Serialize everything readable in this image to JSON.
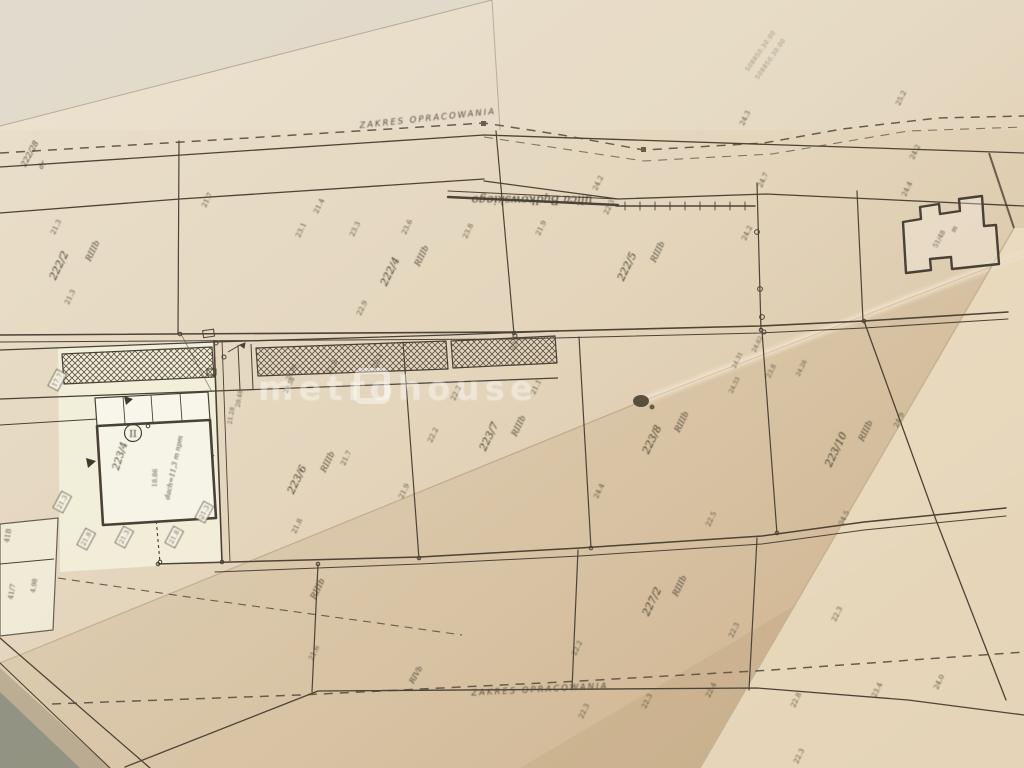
{
  "meta": {
    "title": "cadastral map photo",
    "watermark": "metrohouse"
  },
  "labels": [
    {
      "t": "ZAKRES OPRACOWANIA",
      "x": 428,
      "y": 121,
      "r": -6,
      "s": 8.5,
      "k": "zakres"
    },
    {
      "t": "ZAKRES OPRACOWANIA",
      "x": 540,
      "y": 692,
      "r": -3,
      "s": 8.5,
      "k": "zakres"
    },
    {
      "t": "ulica Bądkowskiego",
      "x": 532,
      "y": 196,
      "r": 180,
      "s": 12,
      "k": "street"
    },
    {
      "t": "508850.30.00",
      "x": 762,
      "y": 52,
      "r": -55,
      "s": 6,
      "k": "stamp"
    },
    {
      "t": "508850.30.00",
      "x": 772,
      "y": 60,
      "r": -55,
      "s": 6,
      "k": "stamp"
    },
    {
      "t": "metrohouse",
      "x": 398,
      "y": 400,
      "r": 0,
      "s": 34,
      "k": "wm",
      "a": "start"
    },
    {
      "t": "222/28",
      "x": 32,
      "y": 155,
      "r": -62,
      "s": 8,
      "k": "parcel"
    },
    {
      "t": "dr",
      "x": 44,
      "y": 166,
      "r": -62,
      "s": 7,
      "k": "soil"
    },
    {
      "t": "222/2",
      "x": 62,
      "y": 267,
      "r": -64,
      "s": 10.5,
      "k": "parcel"
    },
    {
      "t": "RIIIb",
      "x": 95,
      "y": 252,
      "r": -64,
      "s": 8.5,
      "k": "soil"
    },
    {
      "t": "222/4",
      "x": 393,
      "y": 273,
      "r": -64,
      "s": 10.5,
      "k": "parcel"
    },
    {
      "t": "RIIIb",
      "x": 424,
      "y": 257,
      "r": -64,
      "s": 8.5,
      "k": "soil"
    },
    {
      "t": "222/5",
      "x": 630,
      "y": 268,
      "r": -64,
      "s": 10.5,
      "k": "parcel"
    },
    {
      "t": "RIIIb",
      "x": 660,
      "y": 253,
      "r": -64,
      "s": 8.5,
      "k": "soil"
    },
    {
      "t": "223/6",
      "x": 300,
      "y": 481,
      "r": -64,
      "s": 10.5,
      "k": "parcel"
    },
    {
      "t": "RIIIb",
      "x": 330,
      "y": 463,
      "r": -64,
      "s": 8.5,
      "k": "soil"
    },
    {
      "t": "21.7",
      "x": 348,
      "y": 459,
      "r": -64,
      "s": 7,
      "k": "elev"
    },
    {
      "t": "223/7",
      "x": 492,
      "y": 438,
      "r": -64,
      "s": 10.5,
      "k": "parcel"
    },
    {
      "t": "RIIIb",
      "x": 521,
      "y": 427,
      "r": -64,
      "s": 8.5,
      "k": "soil"
    },
    {
      "t": "223/8",
      "x": 655,
      "y": 441,
      "r": -64,
      "s": 10.5,
      "k": "parcel"
    },
    {
      "t": "RIIIb",
      "x": 684,
      "y": 423,
      "r": -64,
      "s": 8.5,
      "k": "soil"
    },
    {
      "t": "223/10",
      "x": 839,
      "y": 451,
      "r": -64,
      "s": 10.5,
      "k": "parcel"
    },
    {
      "t": "RIIIb",
      "x": 868,
      "y": 432,
      "r": -64,
      "s": 8.5,
      "k": "soil"
    },
    {
      "t": "227/2",
      "x": 655,
      "y": 603,
      "r": -64,
      "s": 10.5,
      "k": "parcel"
    },
    {
      "t": "RIIIb",
      "x": 682,
      "y": 587,
      "r": -64,
      "s": 8.5,
      "k": "soil"
    },
    {
      "t": "223/4",
      "x": 123,
      "y": 457,
      "r": -72,
      "s": 10,
      "k": "parcel"
    },
    {
      "t": "RIIIb",
      "x": 320,
      "y": 590,
      "r": -64,
      "s": 8.5,
      "k": "soil"
    },
    {
      "t": "RIVb",
      "x": 418,
      "y": 676,
      "r": -60,
      "s": 7.5,
      "k": "soil"
    },
    {
      "t": "dach=11,3 m npm",
      "x": 176,
      "y": 468,
      "r": -78,
      "s": 7,
      "k": "note"
    },
    {
      "t": "18.86",
      "x": 157,
      "y": 478,
      "r": -88,
      "s": 6.5,
      "k": "tiny"
    },
    {
      "t": "51/48",
      "x": 941,
      "y": 240,
      "r": -62,
      "s": 6.5,
      "k": "tiny"
    },
    {
      "t": "m",
      "x": 956,
      "y": 230,
      "r": -62,
      "s": 6.5,
      "k": "tiny"
    },
    {
      "t": "II",
      "x": 133,
      "y": 437,
      "r": 0,
      "s": 9.5,
      "k": "circled"
    },
    {
      "t": "41B",
      "x": 10,
      "y": 536,
      "r": -80,
      "s": 7,
      "k": "tiny"
    },
    {
      "t": "41/7",
      "x": 14,
      "y": 592,
      "r": -80,
      "s": 7,
      "k": "tiny"
    },
    {
      "t": "4.98",
      "x": 36,
      "y": 586,
      "r": -80,
      "s": 6.5,
      "k": "tiny"
    },
    {
      "t": "21.3",
      "x": 58,
      "y": 228,
      "r": -64,
      "s": 7,
      "k": "elev"
    },
    {
      "t": "21.3",
      "x": 72,
      "y": 298,
      "r": -64,
      "s": 7,
      "k": "elev"
    },
    {
      "t": "21.7",
      "x": 209,
      "y": 201,
      "r": -64,
      "s": 7,
      "k": "elev"
    },
    {
      "t": "21.4",
      "x": 321,
      "y": 207,
      "r": -64,
      "s": 7,
      "k": "elev"
    },
    {
      "t": "23.1",
      "x": 303,
      "y": 231,
      "r": -64,
      "s": 7,
      "k": "elev"
    },
    {
      "t": "23.3",
      "x": 357,
      "y": 230,
      "r": -64,
      "s": 7,
      "k": "elev"
    },
    {
      "t": "23.6",
      "x": 409,
      "y": 228,
      "r": -64,
      "s": 7,
      "k": "elev"
    },
    {
      "t": "23.8",
      "x": 470,
      "y": 232,
      "r": -64,
      "s": 7,
      "k": "elev"
    },
    {
      "t": "21.9",
      "x": 543,
      "y": 229,
      "r": -64,
      "s": 7,
      "k": "elev"
    },
    {
      "t": "22.3",
      "x": 611,
      "y": 208,
      "r": -64,
      "s": 7,
      "k": "elev"
    },
    {
      "t": "24.2",
      "x": 600,
      "y": 184,
      "r": -64,
      "s": 7,
      "k": "elev"
    },
    {
      "t": "22.9",
      "x": 364,
      "y": 309,
      "r": -64,
      "s": 7,
      "k": "elev"
    },
    {
      "t": "24.3",
      "x": 747,
      "y": 119,
      "r": -64,
      "s": 7,
      "k": "elev"
    },
    {
      "t": "24.7",
      "x": 765,
      "y": 181,
      "r": -64,
      "s": 7,
      "k": "elev"
    },
    {
      "t": "24.2",
      "x": 749,
      "y": 234,
      "r": -64,
      "s": 7,
      "k": "elev"
    },
    {
      "t": "25.2",
      "x": 903,
      "y": 99,
      "r": -64,
      "s": 7,
      "k": "elev"
    },
    {
      "t": "24.2",
      "x": 917,
      "y": 153,
      "r": -64,
      "s": 7,
      "k": "elev"
    },
    {
      "t": "24.4",
      "x": 909,
      "y": 190,
      "r": -64,
      "s": 7,
      "k": "elev"
    },
    {
      "t": "23.1",
      "x": 517,
      "y": 344,
      "r": -64,
      "s": 7,
      "k": "elev"
    },
    {
      "t": "22.3",
      "x": 379,
      "y": 362,
      "r": -64,
      "s": 7,
      "k": "elev"
    },
    {
      "t": "22.2",
      "x": 334,
      "y": 368,
      "r": -64,
      "s": 7,
      "k": "elev"
    },
    {
      "t": "20.98",
      "x": 293,
      "y": 373,
      "r": -64,
      "s": 6,
      "k": "elev"
    },
    {
      "t": "20.58",
      "x": 291,
      "y": 386,
      "r": -64,
      "s": 6,
      "k": "elev"
    },
    {
      "t": "21.28",
      "x": 233,
      "y": 416,
      "r": -80,
      "s": 6,
      "k": "elev"
    },
    {
      "t": "20.48",
      "x": 241,
      "y": 399,
      "r": -80,
      "s": 6,
      "k": "elev"
    },
    {
      "t": "22.2",
      "x": 435,
      "y": 436,
      "r": -64,
      "s": 7,
      "k": "elev"
    },
    {
      "t": "22.2",
      "x": 458,
      "y": 394,
      "r": -64,
      "s": 7,
      "k": "elev"
    },
    {
      "t": "21.1",
      "x": 538,
      "y": 388,
      "r": -64,
      "s": 7,
      "k": "elev"
    },
    {
      "t": "21.9",
      "x": 406,
      "y": 492,
      "r": -64,
      "s": 7,
      "k": "elev"
    },
    {
      "t": "21.8",
      "x": 299,
      "y": 527,
      "r": -64,
      "s": 7,
      "k": "elev"
    },
    {
      "t": "24.31",
      "x": 739,
      "y": 361,
      "r": -64,
      "s": 6,
      "k": "elev"
    },
    {
      "t": "24.33",
      "x": 736,
      "y": 386,
      "r": -64,
      "s": 6,
      "k": "elev"
    },
    {
      "t": "24.62",
      "x": 759,
      "y": 345,
      "r": -64,
      "s": 6,
      "k": "elev"
    },
    {
      "t": "23.8",
      "x": 773,
      "y": 372,
      "r": -64,
      "s": 6.5,
      "k": "elev"
    },
    {
      "t": "24.28",
      "x": 803,
      "y": 369,
      "r": -64,
      "s": 6,
      "k": "elev"
    },
    {
      "t": "22.5",
      "x": 713,
      "y": 520,
      "r": -64,
      "s": 7,
      "k": "elev"
    },
    {
      "t": "24.4",
      "x": 601,
      "y": 492,
      "r": -64,
      "s": 7,
      "k": "elev"
    },
    {
      "t": "24.9",
      "x": 901,
      "y": 421,
      "r": -64,
      "s": 7,
      "k": "elev"
    },
    {
      "t": "24.5",
      "x": 846,
      "y": 519,
      "r": -64,
      "s": 7,
      "k": "elev"
    },
    {
      "t": "22.3",
      "x": 736,
      "y": 631,
      "r": -64,
      "s": 7,
      "k": "elev"
    },
    {
      "t": "22.2",
      "x": 579,
      "y": 649,
      "r": -64,
      "s": 7,
      "k": "elev"
    },
    {
      "t": "22.3",
      "x": 586,
      "y": 712,
      "r": -64,
      "s": 7,
      "k": "elev"
    },
    {
      "t": "22.3",
      "x": 649,
      "y": 702,
      "r": -64,
      "s": 7,
      "k": "elev"
    },
    {
      "t": "22.4",
      "x": 713,
      "y": 691,
      "r": -64,
      "s": 7,
      "k": "elev"
    },
    {
      "t": "22.3",
      "x": 839,
      "y": 615,
      "r": -64,
      "s": 7,
      "k": "elev"
    },
    {
      "t": "22.8",
      "x": 798,
      "y": 701,
      "r": -64,
      "s": 7,
      "k": "elev"
    },
    {
      "t": "23.4",
      "x": 879,
      "y": 691,
      "r": -64,
      "s": 7,
      "k": "elev"
    },
    {
      "t": "24.0",
      "x": 941,
      "y": 683,
      "r": -64,
      "s": 7,
      "k": "elev"
    },
    {
      "t": "22.3",
      "x": 801,
      "y": 757,
      "r": -64,
      "s": 7,
      "k": "elev"
    },
    {
      "t": "21.6",
      "x": 316,
      "y": 654,
      "r": -64,
      "s": 7,
      "k": "elev"
    },
    {
      "t": "21.3",
      "x": 64,
      "y": 503,
      "r": -62,
      "s": 6.5,
      "k": "boxed"
    },
    {
      "t": "21.8",
      "x": 88,
      "y": 540,
      "r": -62,
      "s": 6.5,
      "k": "boxed"
    },
    {
      "t": "21.3",
      "x": 126,
      "y": 538,
      "r": -62,
      "s": 6.5,
      "k": "boxed"
    },
    {
      "t": "21.8",
      "x": 176,
      "y": 538,
      "r": -62,
      "s": 6.5,
      "k": "boxed"
    },
    {
      "t": "21.3",
      "x": 206,
      "y": 513,
      "r": -62,
      "s": 6.5,
      "k": "boxed"
    },
    {
      "t": "17.7",
      "x": 59,
      "y": 381,
      "r": -62,
      "s": 6.5,
      "k": "boxed"
    }
  ]
}
